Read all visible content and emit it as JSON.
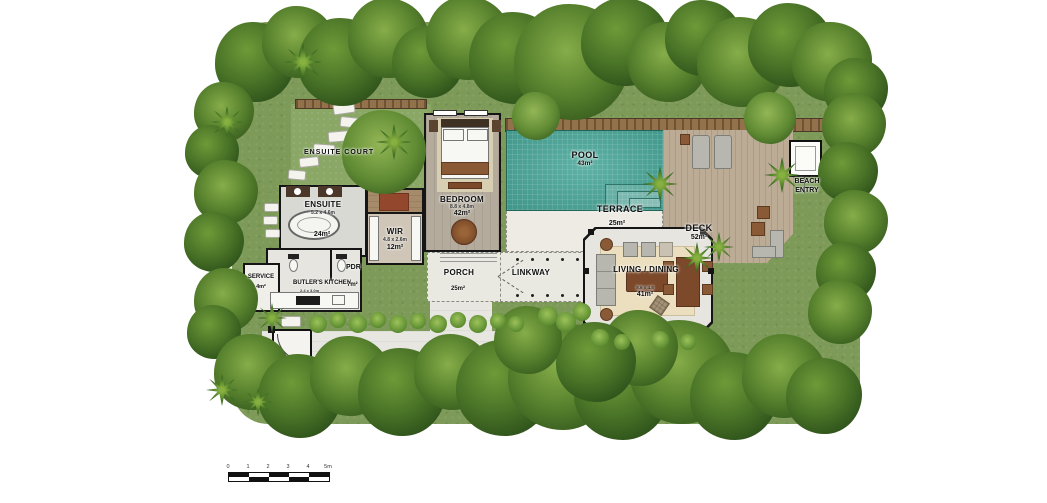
{
  "plan": {
    "rooms": {
      "ensuite_court": {
        "label": "ENSUITE COURT"
      },
      "ensuite": {
        "label": "ENSUITE",
        "dims": "5.2 x 4.6m",
        "area": "24m²"
      },
      "wir": {
        "label": "WIR",
        "dims": "4.8 x 2.6m",
        "area": "12m²"
      },
      "bedroom": {
        "label": "BEDROOM",
        "dims": "8.8 x 4.8m",
        "area": "42m²"
      },
      "pool": {
        "label": "POOL",
        "area": "43m²"
      },
      "terrace": {
        "label": "TERRACE",
        "area": "25m²"
      },
      "deck": {
        "label": "DECK",
        "area": "52m²"
      },
      "beach_entry": {
        "label": "BEACH ENTRY"
      },
      "porch": {
        "label": "PORCH",
        "area": "25m²"
      },
      "linkway": {
        "label": "LINKWAY"
      },
      "living_dining": {
        "label": "LIVING / DINING",
        "dims": "8.6 x 4.8",
        "area": "41m²"
      },
      "butlers_kitchen": {
        "label": "BUTLER'S KITCHEN",
        "dims": "2.4 x 3.0m",
        "area": "7m²"
      },
      "service": {
        "label": "SERVICE",
        "area": "4m²"
      },
      "pdr": {
        "label": "PDR"
      }
    },
    "scale_bar": {
      "ticks": [
        "0",
        "1",
        "2",
        "3",
        "4",
        "5m"
      ]
    },
    "colors": {
      "pool_water": "#4da99b",
      "lawn": "#7d9a58",
      "deck_wood": "#bcab95",
      "fence_wood": "#93714a",
      "wall": "#151515"
    }
  }
}
